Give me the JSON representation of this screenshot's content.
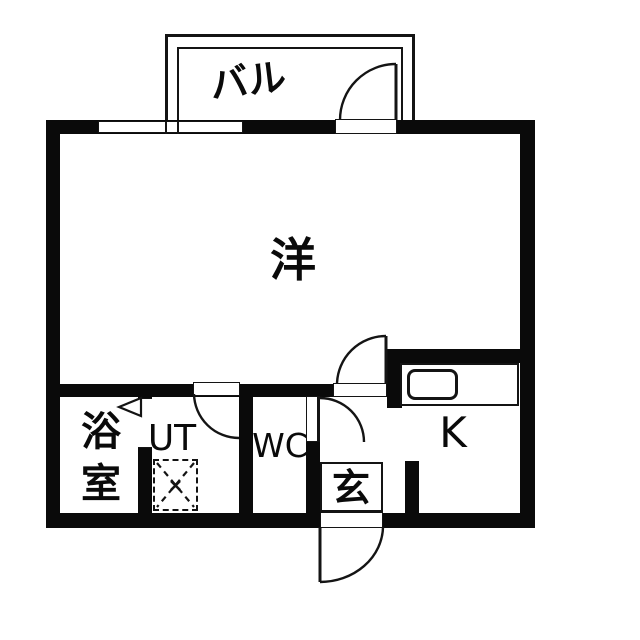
{
  "floorplan": {
    "type": "japanese-apartment-floor-plan",
    "colors": {
      "wall": "#0a0a0a",
      "floor": "#ffffff",
      "line": "#141414"
    },
    "rooms": {
      "balcony": {
        "label": "バル"
      },
      "western_room": {
        "label": "洋"
      },
      "bathroom": {
        "label": "浴室",
        "chars": [
          "浴",
          "室"
        ]
      },
      "utility": {
        "label": "UT"
      },
      "toilet": {
        "label": "WC"
      },
      "entrance": {
        "label": "玄"
      },
      "kitchen": {
        "label": "K"
      }
    },
    "symbols": [
      "balcony-door-swing-arc",
      "living-room-door-swing-arc",
      "utility-door-swing-arc",
      "toilet-door-swing-arc",
      "front-door-swing-arc",
      "bathroom-folding-door-triangle",
      "washing-machine-place-dashed-box",
      "kitchen-sink-counter",
      "window-double-pane"
    ]
  }
}
